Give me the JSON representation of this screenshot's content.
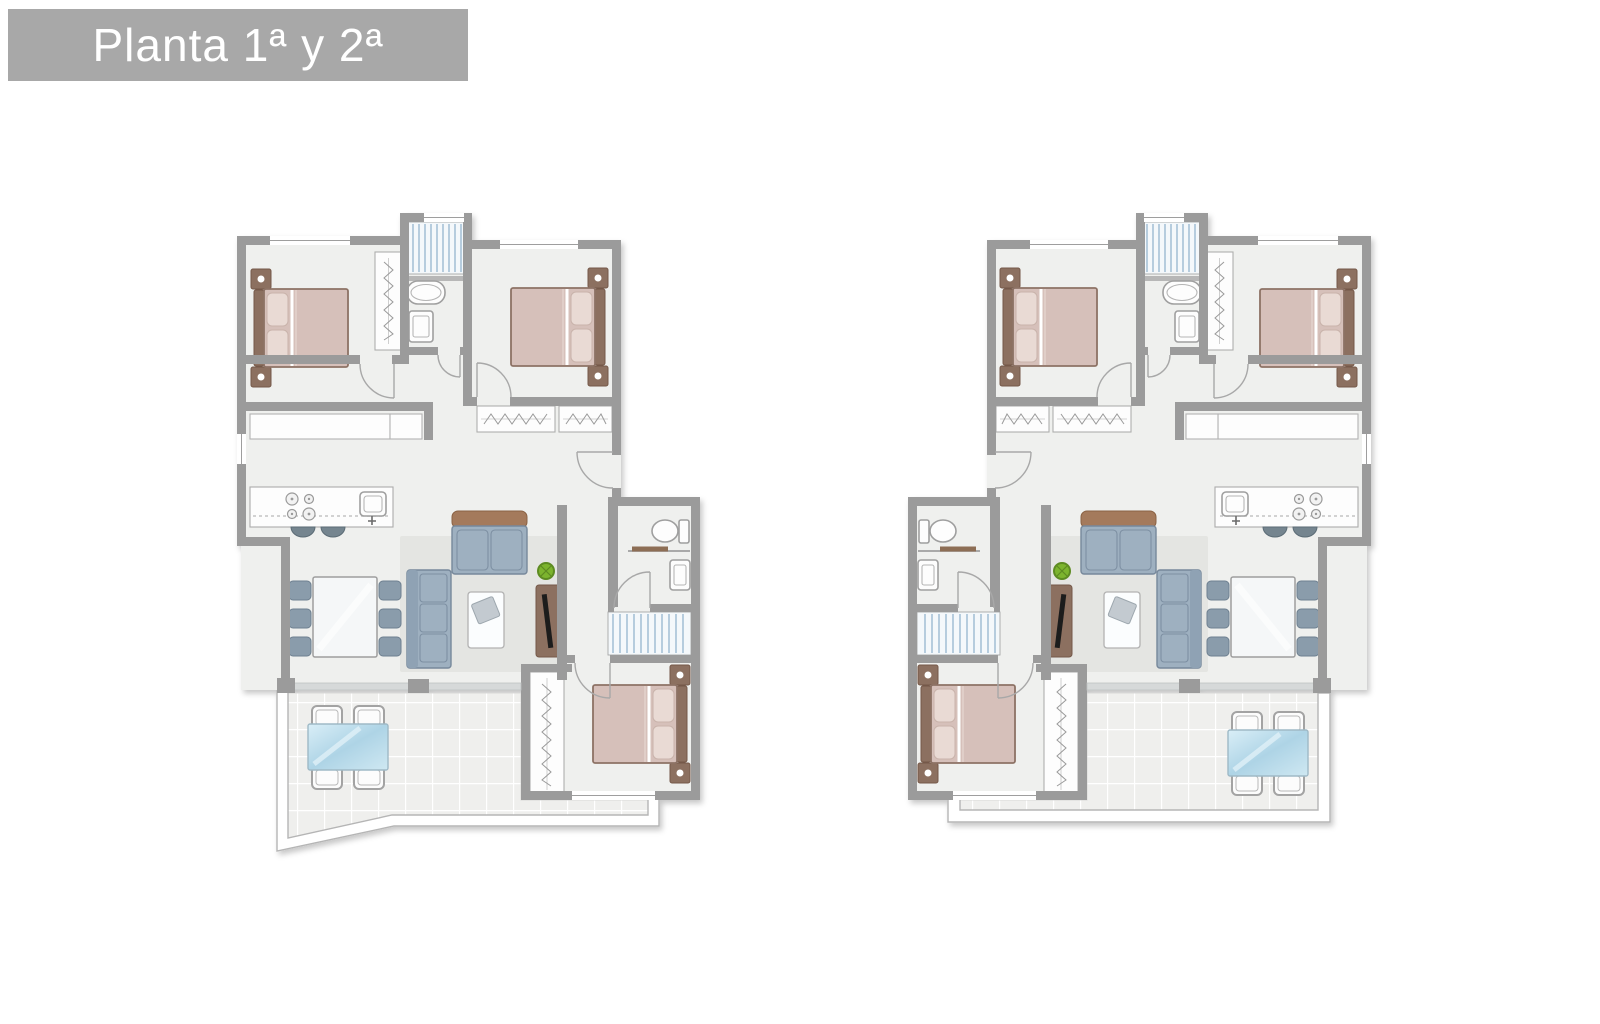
{
  "title": {
    "label": "Planta 1ª y 2ª"
  },
  "plans": {
    "left": {
      "id": "plan-left",
      "description": "apartment-unit-floor-plan",
      "mirrored": false,
      "terrace_shape": "diagonal-corner"
    },
    "right": {
      "id": "plan-right",
      "description": "apartment-unit-floor-plan",
      "mirrored": true,
      "terrace_shape": "rectangular"
    },
    "rooms": [
      "bedroom-1",
      "bedroom-2",
      "bedroom-3",
      "bathroom-1",
      "bathroom-2",
      "kitchen",
      "living-dining-room",
      "hall",
      "staircase",
      "terrace"
    ],
    "furniture": [
      "double-bed",
      "nightstand",
      "wardrobe",
      "bathtub",
      "toilet",
      "washbasin",
      "shower",
      "kitchen-counter",
      "stools",
      "dining-table-6-chairs",
      "sofa",
      "coffee-table",
      "tv-unit",
      "plant",
      "patio-table-4-chairs"
    ]
  },
  "colors": {
    "banner_bg": "#a8a8a8",
    "banner_text": "#ffffff",
    "wall": "#9b9b9b",
    "floor": "#eff0ee",
    "tile": "#efefed",
    "tile_line": "#ffffff",
    "stair_bg": "#f4f8fb",
    "stair_tread": "#afc8db",
    "bed": "#d6c0ba",
    "pillow": "#e9dad4",
    "wood": "#8c7060",
    "sofa": "#9eb0c0",
    "sofa_back": "#a47a5b",
    "chair": "#8a9cab",
    "rug": "#e4e5e2",
    "counter": "#fdfdfd",
    "plant": "#7cb42d",
    "table_glass": "#bcdcec"
  }
}
